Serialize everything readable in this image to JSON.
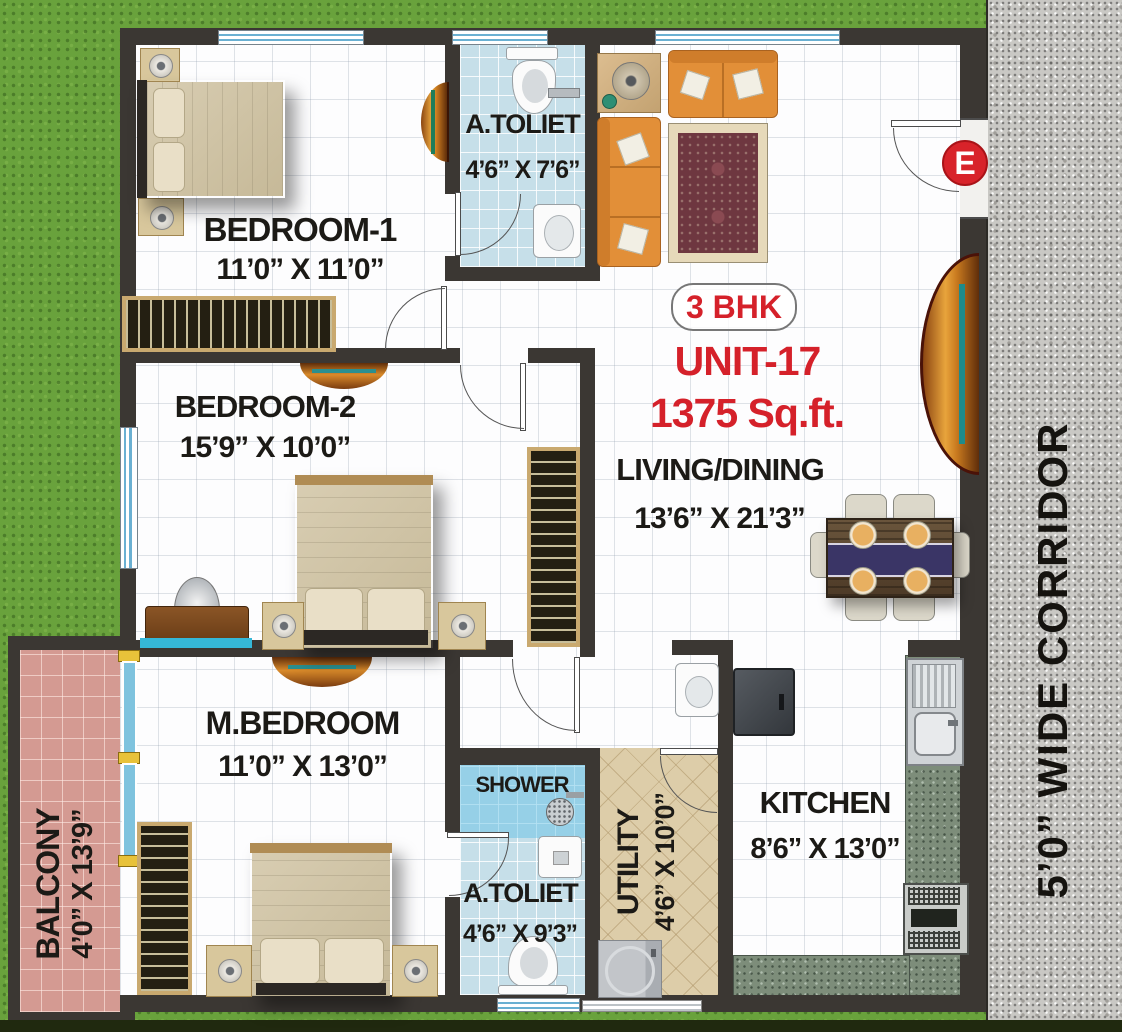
{
  "unit": {
    "badge": "3 BHK",
    "name": "UNIT-17",
    "area": "1375 Sq.ft."
  },
  "compass": {
    "east": "E"
  },
  "corridor": {
    "label": "5’0” WIDE CORRIDOR"
  },
  "rooms": {
    "bedroom1": {
      "name": "BEDROOM-1",
      "dims": "11’0” X 11’0”"
    },
    "toilet_top": {
      "name": "A.TOLIET",
      "dims": "4’6” X 7’6”"
    },
    "bedroom2": {
      "name": "BEDROOM-2",
      "dims": "15’9” X 10’0”"
    },
    "living": {
      "name": "LIVING/DINING",
      "dims": "13’6” X 21’3”"
    },
    "mbedroom": {
      "name": "M.BEDROOM",
      "dims": "11’0” X 13’0”"
    },
    "balcony": {
      "name": "BALCONY",
      "dims": "4’0” X 13’9”"
    },
    "shower": {
      "name": "SHOWER"
    },
    "toilet_bottom": {
      "name": "A.TOLIET",
      "dims": "4’6” X 9’3”"
    },
    "utility": {
      "name": "UTILITY",
      "dims": "4’6” X 10’0”"
    },
    "kitchen": {
      "name": "KITCHEN",
      "dims": "8’6” X 13’0”"
    }
  },
  "colors": {
    "accent_red": "#d5212a",
    "wall": "#3b3733",
    "grass": "#69a23c",
    "granite": "#c9c8c4",
    "tile_blue": "#c6dfe9",
    "tile_pink": "#d49a92",
    "tile_beige": "#ddcda9",
    "counter_green": "#7d8d7a"
  }
}
